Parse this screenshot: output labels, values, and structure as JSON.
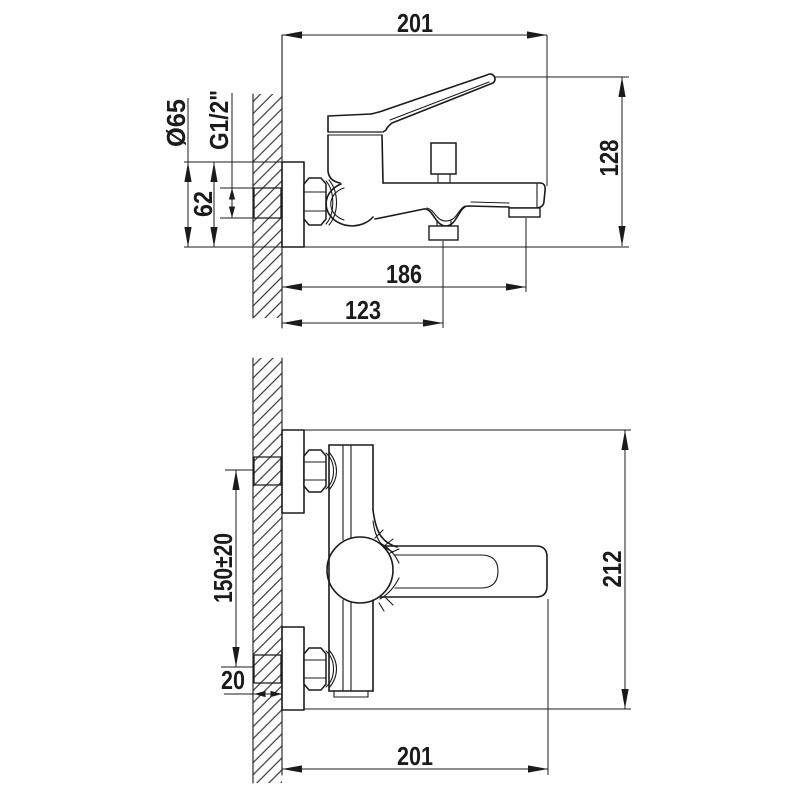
{
  "drawing": {
    "background": "#ffffff",
    "line_color": "#1b1b1b"
  },
  "side_view": {
    "labels": {
      "overall_width": "201",
      "overall_height": "128",
      "escutcheon_diameter": "Ø65",
      "thread_size": "G1/2\"",
      "escutcheon_height": "62",
      "wall_to_aerator": "186",
      "wall_to_diverter": "123"
    }
  },
  "plan_view": {
    "labels": {
      "overall_width": "201",
      "overall_depth": "212",
      "supply_centers": "150±20",
      "wall_thickness": "20"
    }
  }
}
